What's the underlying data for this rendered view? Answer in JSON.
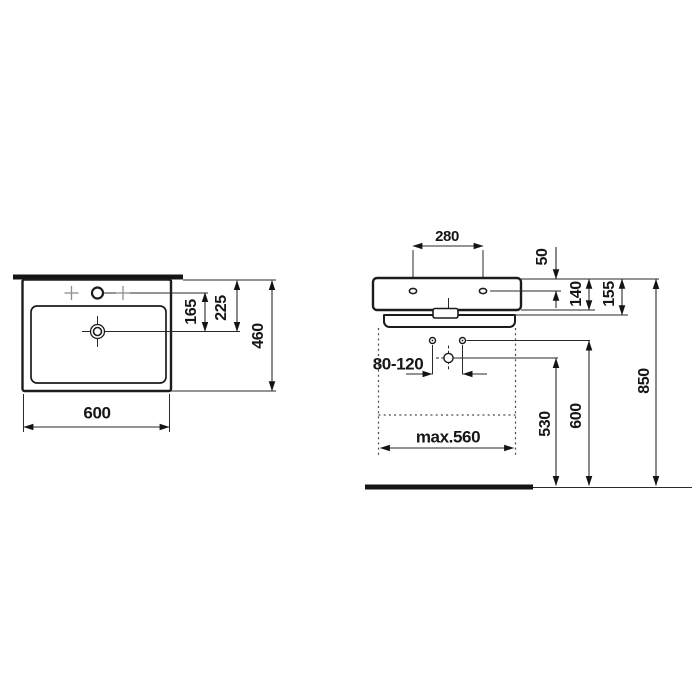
{
  "drawing": {
    "description": "washbasin dimension drawing, top view and front view",
    "colors": {
      "line": "#1c1c1c",
      "background": "#ffffff",
      "cross_marker": "#8f8f8f"
    },
    "top_view": {
      "dim_width": "600",
      "dim_depth": "460",
      "dim_taphole_to_drain": "165",
      "dim_back_to_drain": "225"
    },
    "front_view": {
      "dim_tapholes_spacing": "280",
      "dim_top_to_tapholes": "50",
      "dim_body_height": "140",
      "dim_total_height": "155",
      "dim_fixing_range": "80-120",
      "dim_max_cabinet_width": "max.560",
      "dim_drain_height": "530",
      "dim_fixing_height": "600",
      "dim_rim_height": "850"
    }
  }
}
